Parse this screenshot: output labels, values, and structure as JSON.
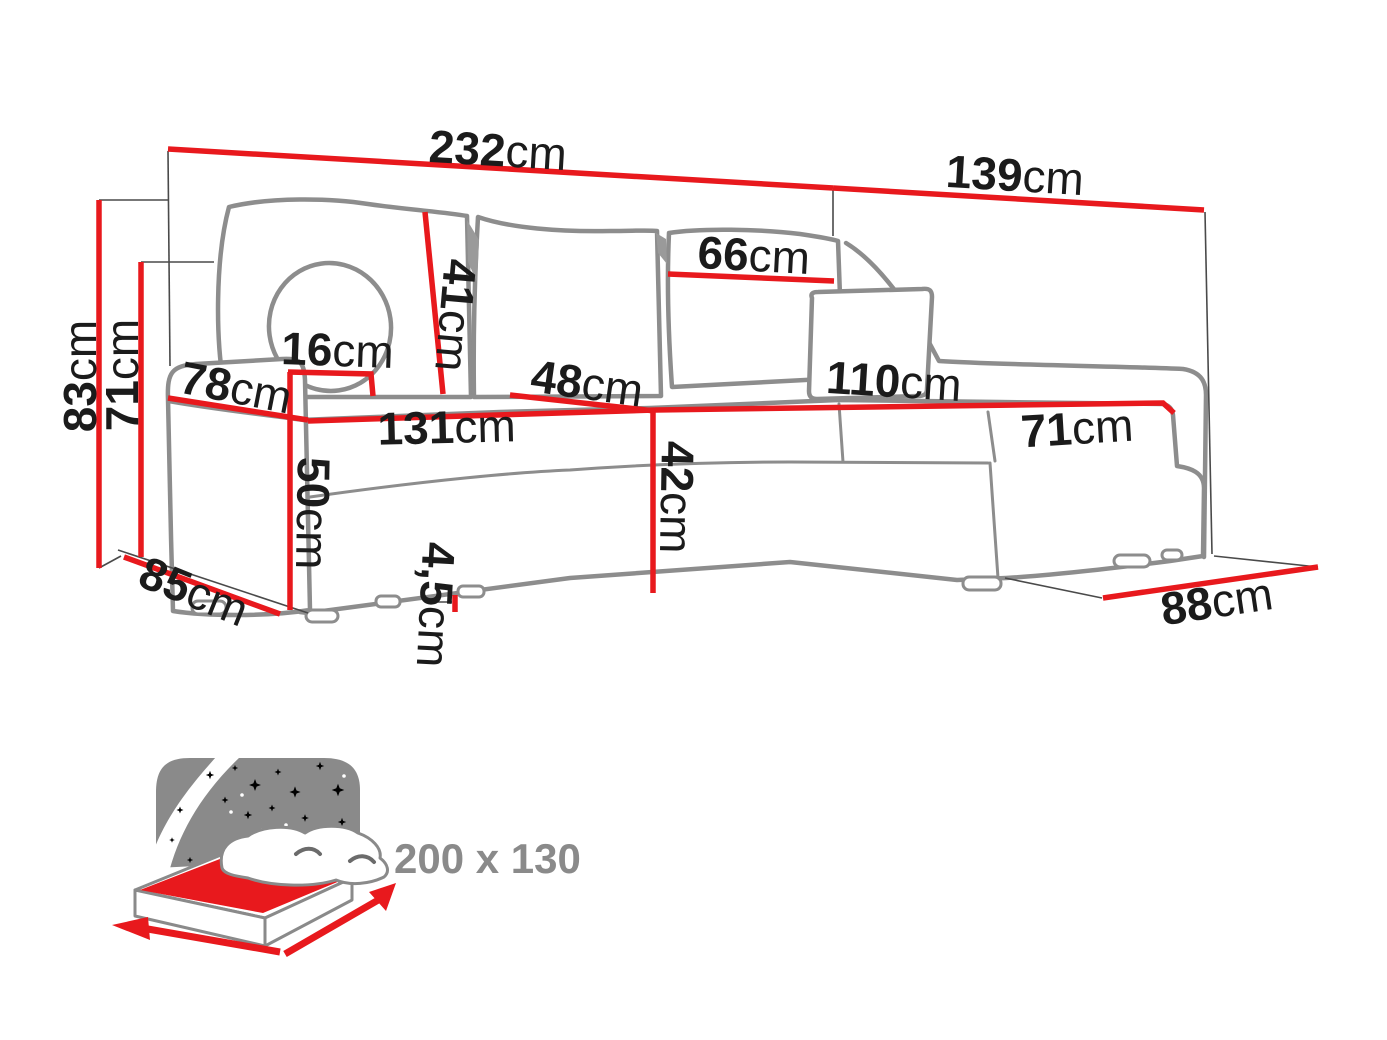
{
  "colors": {
    "dimension_red": "#e8191d",
    "outline_gray": "#8d8d8d",
    "label_black": "#1b1b1b",
    "icon_gray": "#8a8a8a",
    "background": "#ffffff"
  },
  "dimensions": {
    "total_width": {
      "value": "232",
      "unit": "cm"
    },
    "side_depth": {
      "value": "139",
      "unit": "cm"
    },
    "back_cushion_width": {
      "value": "66",
      "unit": "cm"
    },
    "back_cushion_height": {
      "value": "41",
      "unit": "cm"
    },
    "total_height": {
      "value": "83",
      "unit": "cm"
    },
    "backrest_height": {
      "value": "71",
      "unit": "cm"
    },
    "armrest_top_width": {
      "value": "16",
      "unit": "cm"
    },
    "armrest_depth": {
      "value": "78",
      "unit": "cm"
    },
    "seat_depth": {
      "value": "48",
      "unit": "cm"
    },
    "chaise_length": {
      "value": "110",
      "unit": "cm"
    },
    "seat_width": {
      "value": "131",
      "unit": "cm"
    },
    "chaise_seat_width": {
      "value": "71",
      "unit": "cm"
    },
    "armrest_height": {
      "value": "50",
      "unit": "cm"
    },
    "seat_height": {
      "value": "42",
      "unit": "cm"
    },
    "leg_height": {
      "value": "4,5",
      "unit": "cm"
    },
    "base_depth": {
      "value": "85",
      "unit": "cm"
    },
    "chaise_base_width": {
      "value": "88",
      "unit": "cm"
    }
  },
  "sleeping_area": {
    "label": "200 x 130"
  }
}
